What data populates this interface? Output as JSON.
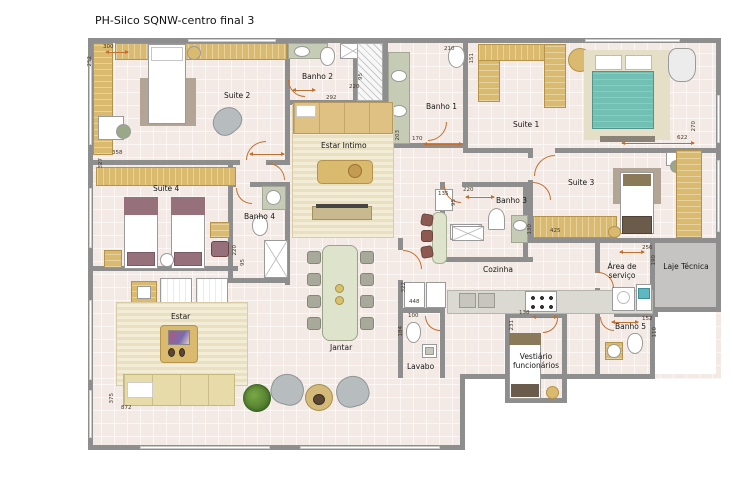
{
  "title": "PH-Silco SQNW-centro final 3",
  "rooms": {
    "suite1": {
      "label": "Suite 1"
    },
    "suite2": {
      "label": "Suite 2"
    },
    "suite3": {
      "label": "Suite 3"
    },
    "suite4": {
      "label": "Suite 4"
    },
    "banho1": {
      "label": "Banho 1"
    },
    "banho2": {
      "label": "Banho 2"
    },
    "banho3": {
      "label": "Banho 3"
    },
    "banho4": {
      "label": "Banho 4"
    },
    "banho5": {
      "label": "Banho 5"
    },
    "estar_intimo": {
      "label": "Estar Intimo"
    },
    "estar": {
      "label": "Estar"
    },
    "jantar": {
      "label": "Jantar"
    },
    "cozinha": {
      "label": "Cozinha"
    },
    "lavabo": {
      "label": "Lavabo"
    },
    "area_servico": {
      "label": "Área de serviço"
    },
    "laje_tecnica": {
      "label": "Laje Técnica"
    },
    "vestiario": {
      "label": "Vestiário funcionários"
    }
  },
  "dims": {
    "d300": "300",
    "d252": "252",
    "d358": "358",
    "d327": "327",
    "d292": "292",
    "d220_b2": "220",
    "d95_b2": "95",
    "d210": "210",
    "d151": "151",
    "d203": "203",
    "d170": "170",
    "d270": "270",
    "d622": "622",
    "d220_b4": "220",
    "d95_b4": "95",
    "d135": "135",
    "d220_b3": "220",
    "d95_b3": "95",
    "d130": "130",
    "d425": "425",
    "d448": "448",
    "d322": "322",
    "d100": "100",
    "d184": "184",
    "d138": "138",
    "d231": "231",
    "d256": "256",
    "d190": "190",
    "d152": "152",
    "d110": "110",
    "d375": "375",
    "d872": "872"
  },
  "colors": {
    "wall": "#8e8e8e",
    "floor": "#f4eae5",
    "wood": "#d9ba6e",
    "bed_teal": "#72bfb4",
    "bed_maroon": "#96707b",
    "door_accent": "#c07030",
    "laje_gray": "#c6c4c2"
  }
}
